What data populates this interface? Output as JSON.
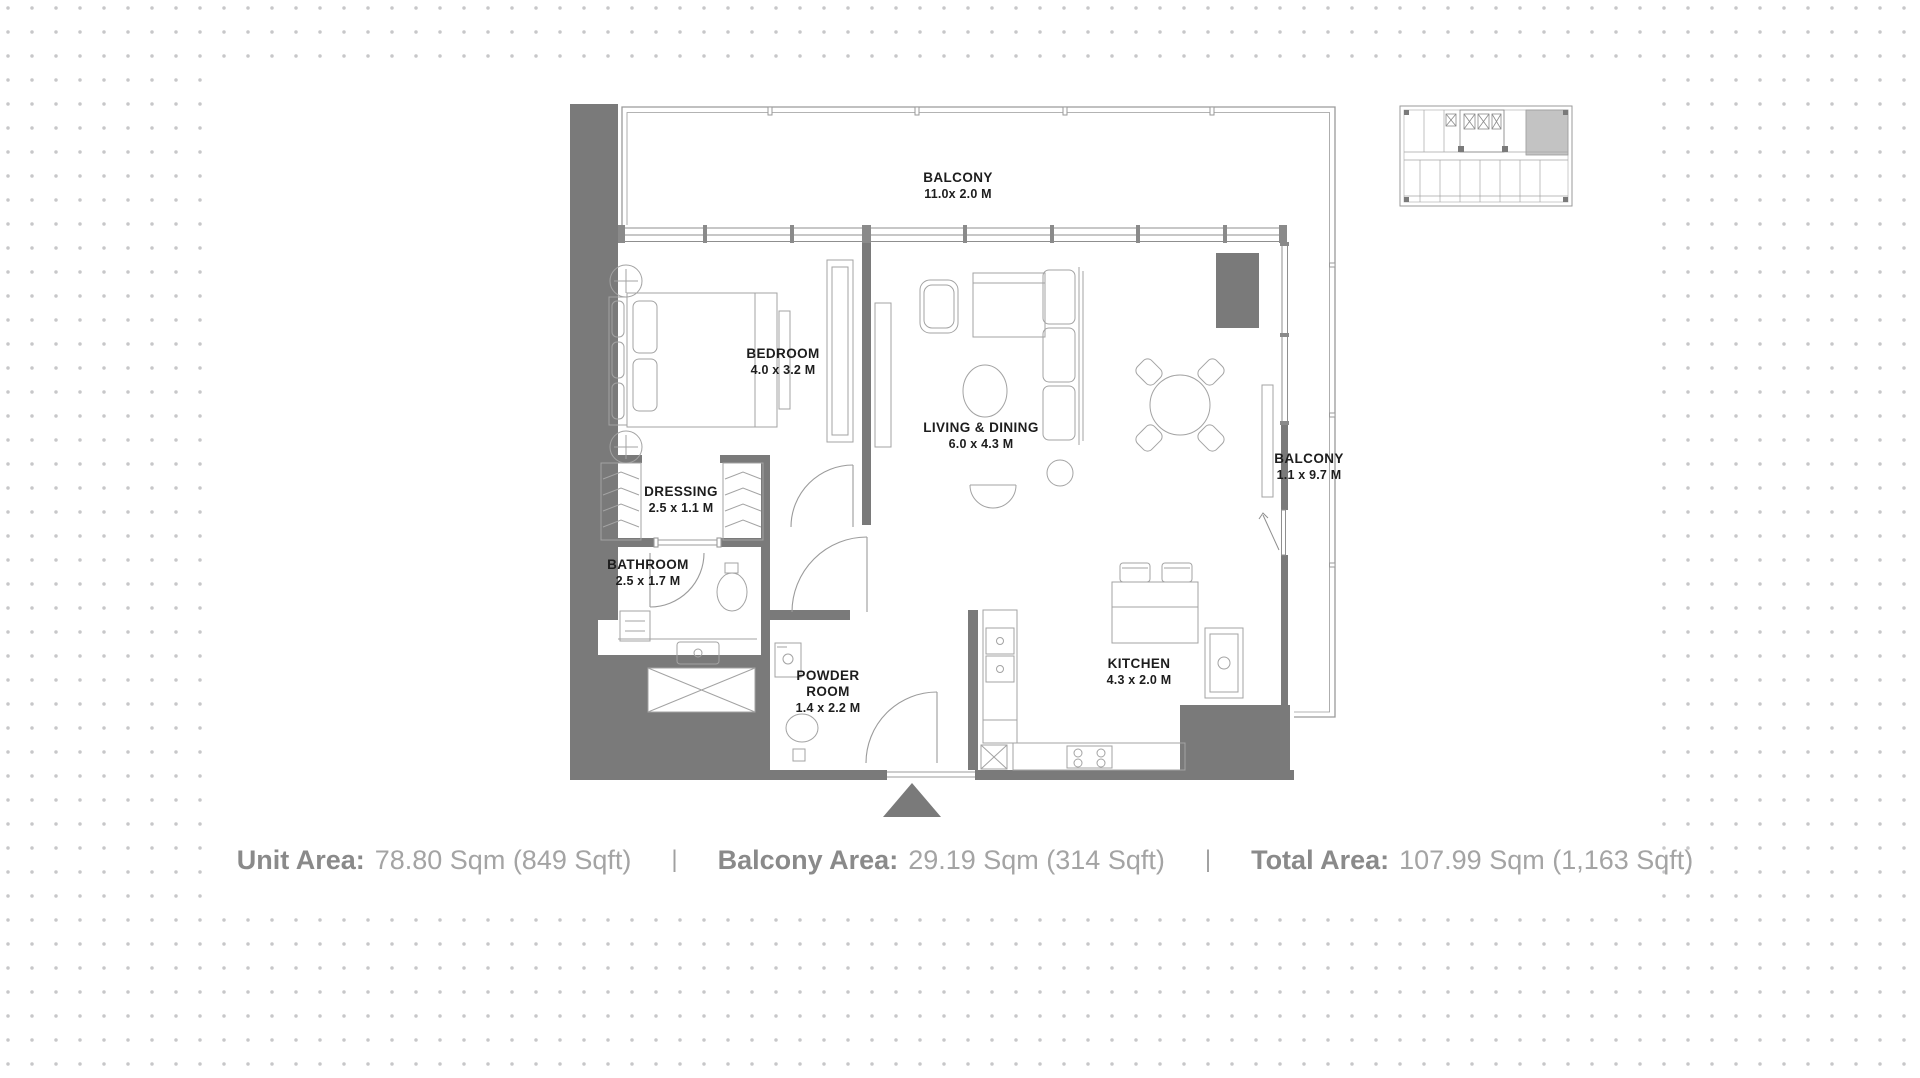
{
  "floorplan": {
    "rooms": [
      {
        "id": "balcony-top",
        "name": "BALCONY",
        "dims": "11.0x 2.0 M"
      },
      {
        "id": "bedroom",
        "name": "BEDROOM",
        "dims": "4.0 x 3.2 M"
      },
      {
        "id": "living-dining",
        "name": "LIVING & DINING",
        "dims": "6.0 x 4.3 M"
      },
      {
        "id": "balcony-right",
        "name": "BALCONY",
        "dims": "1.1 x 9.7 M"
      },
      {
        "id": "dressing",
        "name": "DRESSING",
        "dims": "2.5 x 1.1 M"
      },
      {
        "id": "bathroom",
        "name": "BATHROOM",
        "dims": "2.5 x 1.7 M"
      },
      {
        "id": "powder-room",
        "name": "POWDER ROOM",
        "dims": "1.4 x 2.2 M"
      },
      {
        "id": "kitchen",
        "name": "KITCHEN",
        "dims": "4.3 x 2.0 M"
      }
    ]
  },
  "summary": {
    "separator": "|",
    "items": [
      {
        "label": "Unit Area:",
        "value": "78.80 Sqm (849 Sqft)"
      },
      {
        "label": "Balcony Area:",
        "value": "29.19 Sqm (314 Sqft)"
      },
      {
        "label": "Total Area:",
        "value": "107.99 Sqm (1,163 Sqft)"
      }
    ]
  },
  "colors": {
    "wall": "#7a7a7a",
    "thin_line": "#9b9b9b",
    "background_dot": "#c7c7c9",
    "room_label": "#1d1d1d",
    "summary_label": "#8a8a8a",
    "summary_value": "#a4a4a4",
    "keyplan_highlight": "#c3c3c3"
  }
}
